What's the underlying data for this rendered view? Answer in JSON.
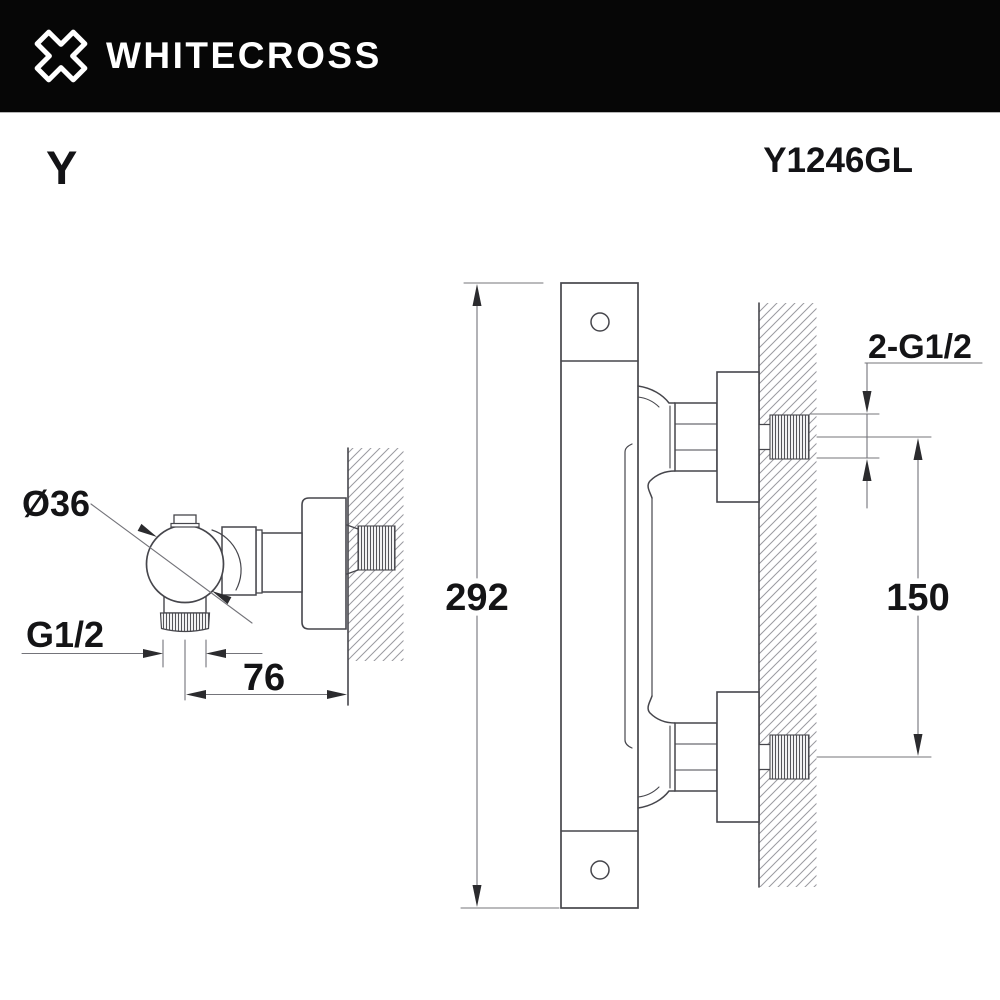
{
  "header": {
    "brand": "WHITECROSS",
    "logo_icon": "whitecross-x-logo",
    "background_color": "#060606",
    "text_color": "#ffffff"
  },
  "product": {
    "series": "Y",
    "model": "Y1246GL"
  },
  "views": {
    "side": {
      "name": "valve-side-view",
      "dims": {
        "knob_diameter": "Ø36",
        "outlet_thread": "G1/2",
        "wall_distance": "76"
      }
    },
    "front": {
      "name": "mixer-front-view",
      "dims": {
        "total_height": "292",
        "connection_spacing": "150",
        "wall_connection_thread": "2-G1/2"
      }
    }
  },
  "colors": {
    "outline": "#46464c",
    "dimension_line": "#74747a",
    "hatch": "#9a9aa0",
    "text": "#141416",
    "arrow": "#2b2b2e"
  }
}
